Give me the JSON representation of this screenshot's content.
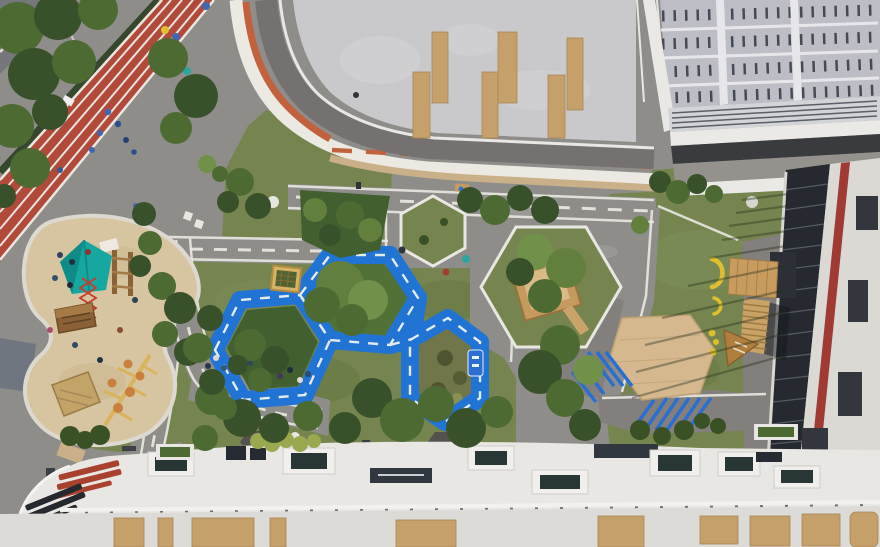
{
  "scene": {
    "description": "Top-down aerial drone photo of a kindergarten courtyard playground between white buildings",
    "view": "top-down aerial",
    "visible_text": [],
    "areas": [
      {
        "name": "running-track",
        "label": "red rubber running track with white lanes and children"
      },
      {
        "name": "street-corner",
        "label": "street corner with dashed centerline, top-left"
      },
      {
        "name": "tree-belt",
        "label": "dense street trees along the track"
      },
      {
        "name": "sand-play-area",
        "label": "kidney-shaped sand pit with teepee, climbing net and play huts"
      },
      {
        "name": "traffic-loop",
        "label": "blue painted cycling loop of three hexagon cells with white dashes"
      },
      {
        "name": "planting-beds",
        "label": "shrub and garden beds inside the blue loop"
      },
      {
        "name": "mini-road-network",
        "label": "gray paths with white dashed road markings"
      },
      {
        "name": "hexagon-grass-island",
        "label": "white-edged hexagonal grass island"
      },
      {
        "name": "treehouse-hexagon",
        "label": "hexagonal lawn with wooden treehouse platform"
      },
      {
        "name": "wooden-hex-deck",
        "label": "large hexagonal timber deck"
      },
      {
        "name": "blue-stripes",
        "label": "blue diagonal pavement stripes beside deck"
      },
      {
        "name": "yellow-play-items",
        "label": "yellow banana-shaped play elements on lawn"
      },
      {
        "name": "branch-balance-beam",
        "label": "wooden branch balance beam with orange discs"
      },
      {
        "name": "amphitheater-stairs",
        "label": "wooden stair / bleacher down from building"
      },
      {
        "name": "top-roof-terrace",
        "label": "curved roof terrace with orange band and timber benches"
      },
      {
        "name": "solar-roof",
        "label": "photovoltaic panel roof, top right"
      },
      {
        "name": "right-facade",
        "label": "dark glass curtain wall with red stripe and louvers"
      },
      {
        "name": "bottom-roof",
        "label": "white roof with skylight boxes and timber panels"
      },
      {
        "name": "children",
        "label": "small figures of children on track, sand and paths"
      }
    ]
  },
  "palette": {
    "pavement": "#8f8d8a",
    "pavementShaded": "#827f7c",
    "grass": "#76854f",
    "grassShade": "#64743f",
    "trackRed": "#b14a3a",
    "laneWhite": "#e9e7e2",
    "blueTrack": "#2173d4",
    "blueStripe": "#2a6fd0",
    "sand": "#d6c5a0",
    "sandRim": "#ddd9d0",
    "roofCream": "#ece9e2",
    "roofGray": "#c9c9cb",
    "terraceTrack": "#747170",
    "bandOrange": "#c2613e",
    "soffitTan": "#c9b088",
    "solarPanel": "#bcbdc5",
    "solarSlot": "#454a54",
    "louverGray": "#d3d4d8",
    "meshDark": "#393b3f",
    "glassDark": "#26292f",
    "wallWhite": "#dbd9d4",
    "stripeRed": "#a03a34",
    "panelDark": "#33363c",
    "bottomRoof": "#e9e7e3",
    "bottomRoofLower": "#dcdbd7",
    "plankTan": "#c5a06b",
    "skylightDark": "#283636",
    "deckWood": "#d6b88f",
    "stairWood": "#c9a266",
    "hutWood": "#8a6136",
    "strawWood": "#c2a468",
    "teal": "#17a7a1",
    "yellow": "#e0bf2e",
    "discOrange": "#c97f3e",
    "treeDark": "#39512a",
    "treeMid": "#4e6a33",
    "treeLight": "#627f3e",
    "treeBright": "#71904a",
    "shrubYellow": "#9aa850",
    "streetGray": "#75777b",
    "whiteDetail": "#eceae6"
  }
}
